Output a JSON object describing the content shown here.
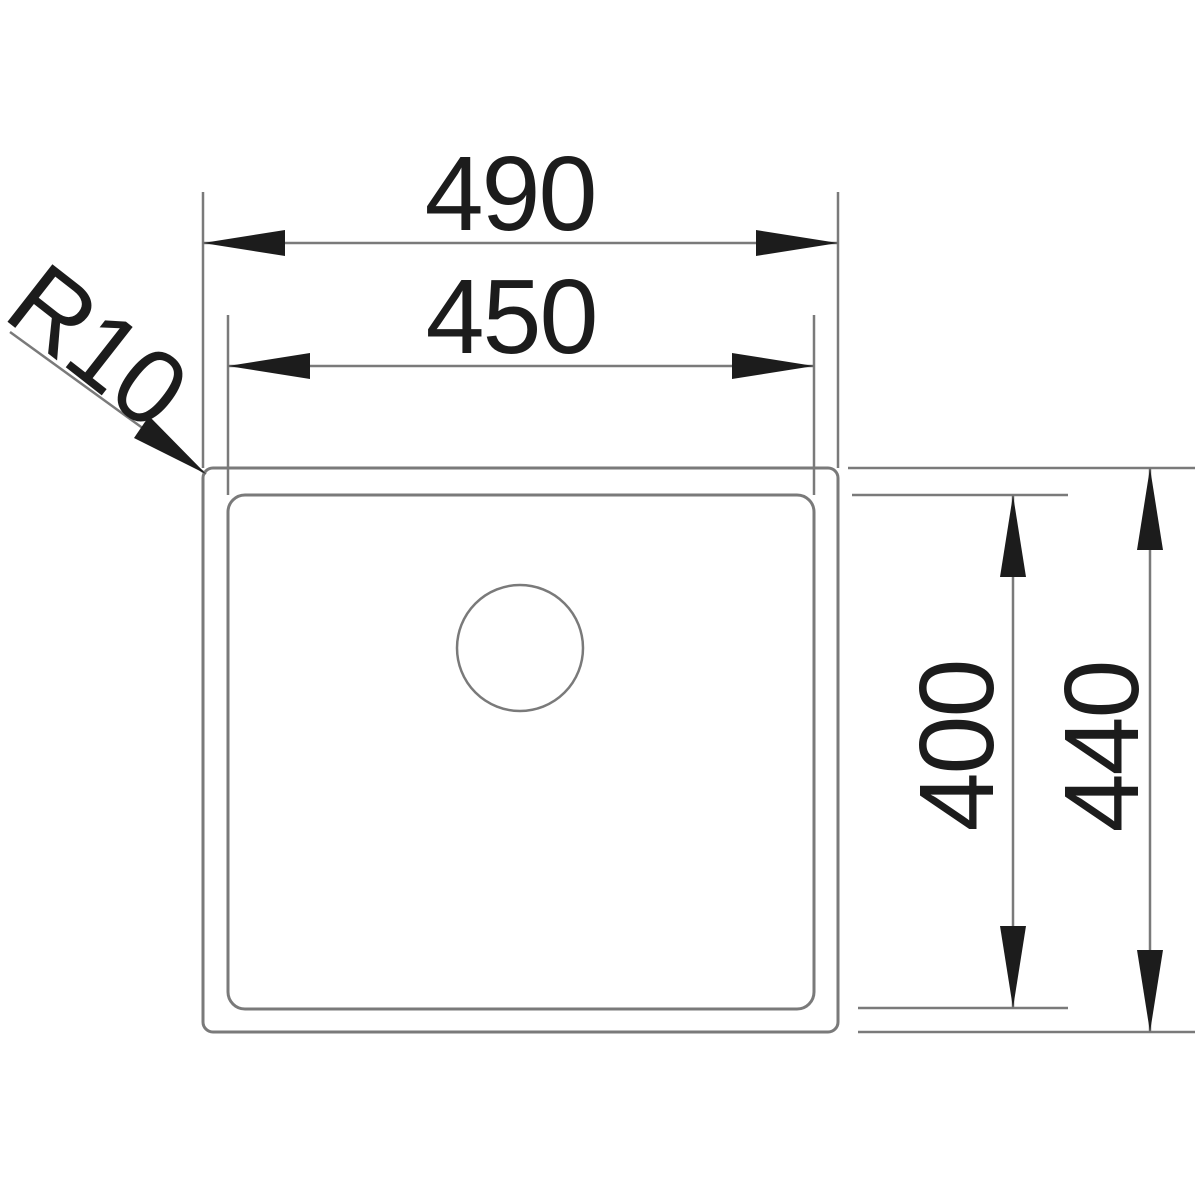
{
  "drawing": {
    "kind": "technical-dimension-drawing",
    "subject": "sink-bowl-top-view",
    "labels": {
      "outer_width": "490",
      "inner_width": "450",
      "inner_height": "400",
      "outer_height": "440",
      "corner_radius": "R10"
    },
    "values_mm": {
      "outer_width": 490,
      "inner_width": 450,
      "inner_height": 400,
      "outer_height": 440,
      "corner_radius": 10
    },
    "colors": {
      "line_gray": "#7a7a7a",
      "ink_black": "#1c1c1c",
      "background": "#ffffff"
    }
  }
}
